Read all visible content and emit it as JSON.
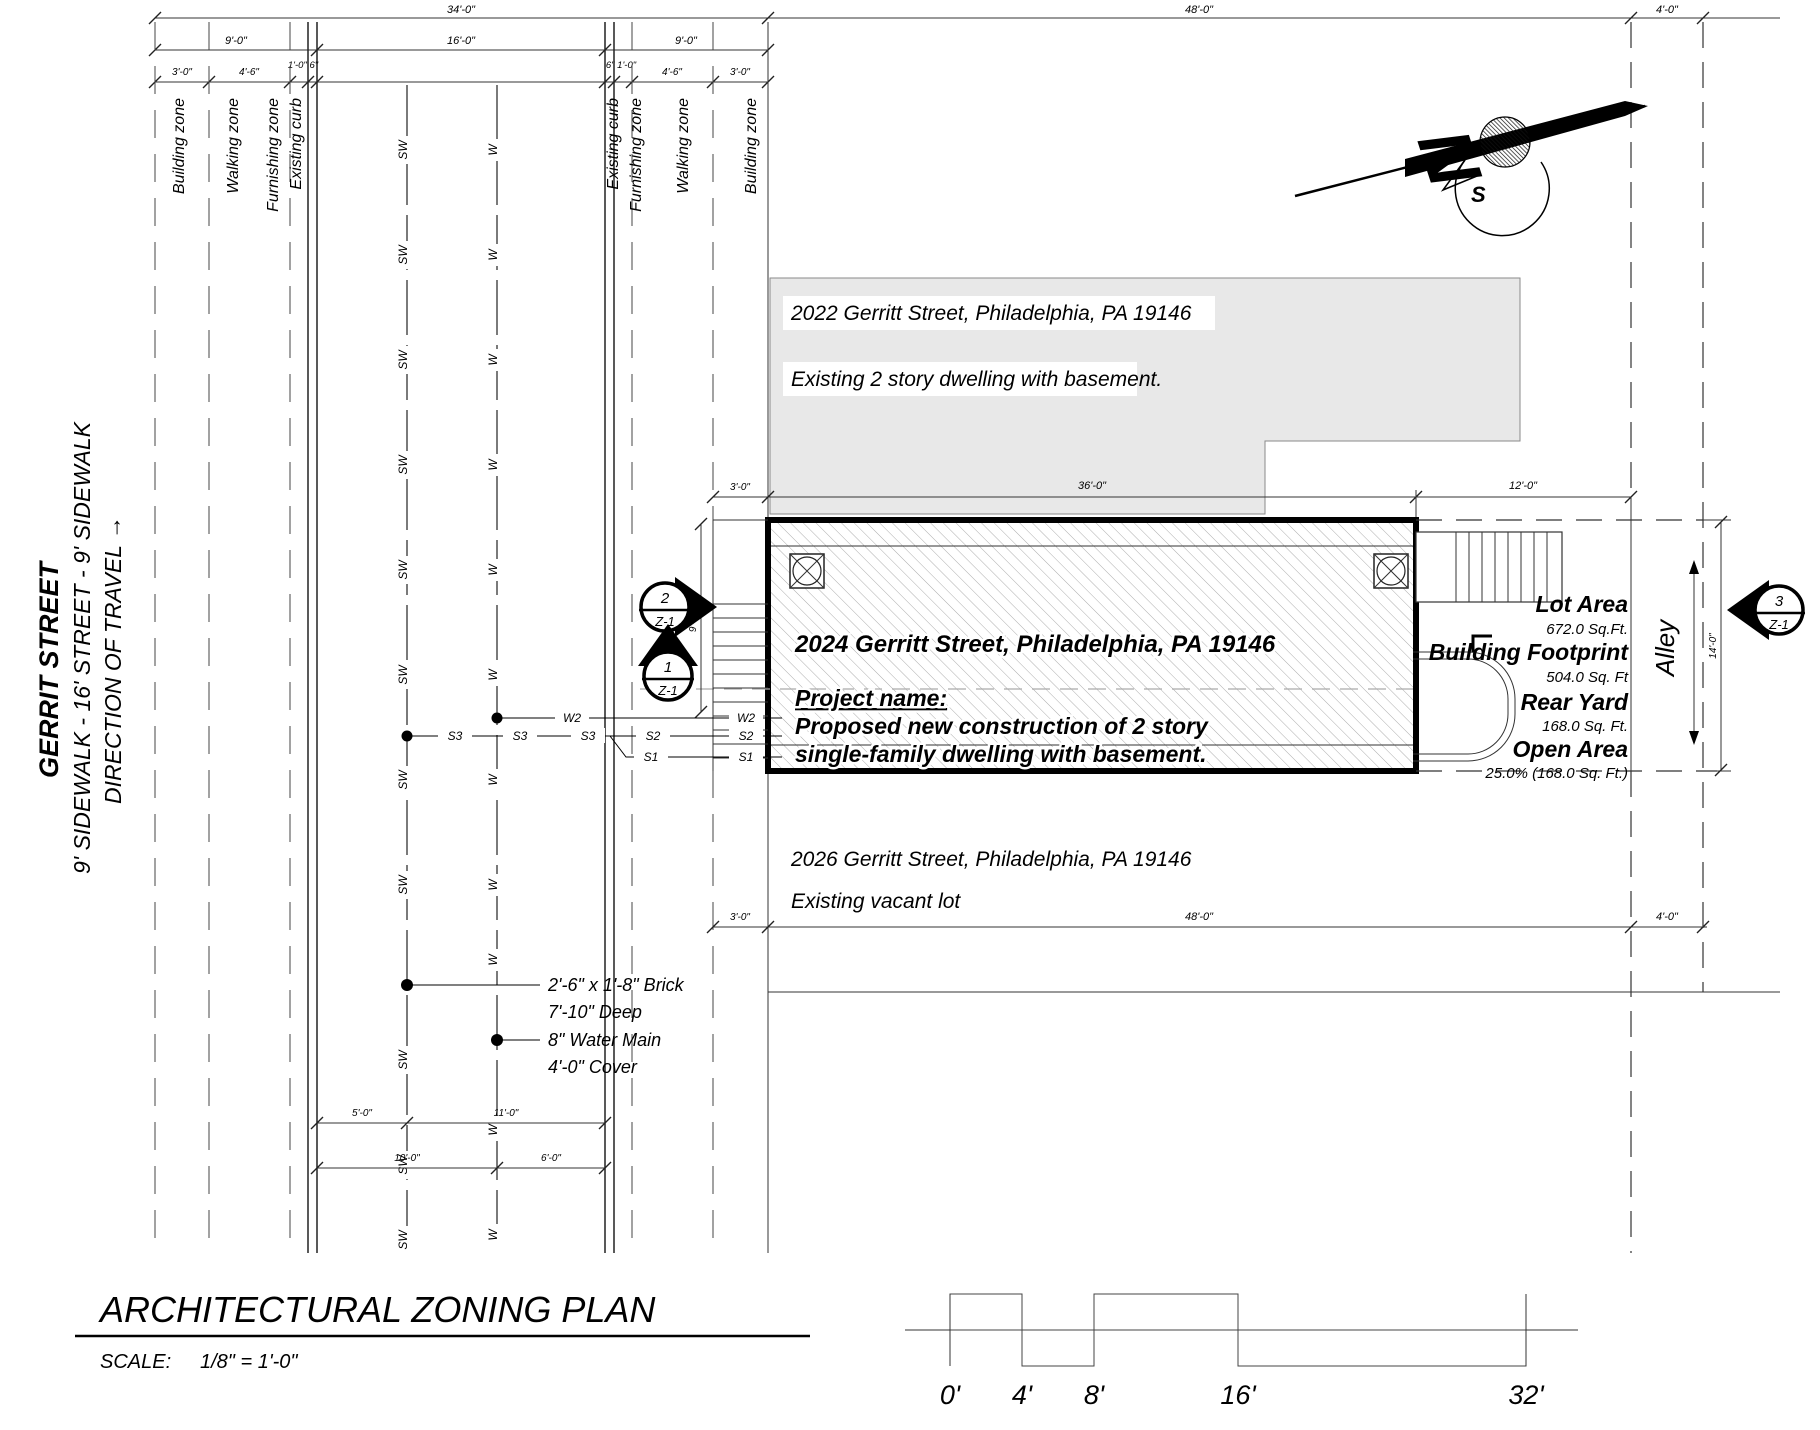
{
  "street": {
    "name": "GERRIT STREET",
    "subtitle": "9' SIDEWALK - 16' STREET - 9' SIDEWALK",
    "direction": "DIRECTION OF TRAVEL →"
  },
  "zones": {
    "building": "Building zone",
    "walking": "Walking zone",
    "furnishing": "Furnishing zone",
    "curb": "Existing curb"
  },
  "dims": {
    "top": {
      "overall_left": "34'-0\"",
      "overall_right": "48'-0\"",
      "alley": "4'-0\""
    },
    "row2": {
      "left_sidewalk": "9'-0\"",
      "street": "16'-0\"",
      "right_sidewalk": "9'-0\""
    },
    "row3": {
      "l_building": "3'-0\"",
      "l_walking": "4'-6\"",
      "l_curb": "1'-0\" 6\"",
      "r_curb": "6\" 1'-0\"",
      "r_walking": "4'-6\"",
      "r_building": "3'-0\""
    },
    "mid": {
      "setback": "3'-0\"",
      "building": "36'-0\"",
      "rear": "12'-0\""
    },
    "lot": {
      "setback": "3'-0\"",
      "width": "48'-0\"",
      "alley": "4'-0\""
    },
    "alley_depth": "14'-0\"",
    "stair": "9'-2¼\"",
    "street_utils": {
      "sw_offset": "5'-0\"",
      "sw_to_curb": "11'-0\"",
      "w_offset": "10'-0\"",
      "w_to_curb": "6'-0\""
    }
  },
  "utilities": {
    "sewer": "SW",
    "water": "W",
    "w2": "W2",
    "s1": "S1",
    "s2": "S2",
    "s3": "S3",
    "brick_note_1": "2'-6\" x 1'-8\" Brick",
    "brick_note_2": "7'-10\" Deep",
    "water_note_1": "8\" Water Main",
    "water_note_2": "4'-0\" Cover"
  },
  "buildings": {
    "b2022": {
      "address": "2022 Gerritt Street, Philadelphia, PA 19146",
      "desc": "Existing 2 story dwelling with basement."
    },
    "b2024": {
      "address": "2024 Gerritt Street, Philadelphia, PA 19146",
      "project_label": "Project name:",
      "project_line1": "Proposed new construction of 2 story",
      "project_line2": "single-family dwelling with basement."
    },
    "b2026": {
      "address": "2026 Gerritt Street, Philadelphia, PA 19146",
      "desc": "Existing vacant lot"
    }
  },
  "stats": [
    {
      "label": "Lot Area",
      "value": "672.0 Sq.Ft."
    },
    {
      "label": "Building Footprint",
      "value": "504.0 Sq. Ft"
    },
    {
      "label": "Rear Yard",
      "value": "168.0 Sq. Ft."
    },
    {
      "label": "Open Area",
      "value": "25.0% (168.0 Sq. Ft.)"
    }
  ],
  "alley": {
    "label": "Alley"
  },
  "callouts": {
    "c1": {
      "num": "1",
      "sheet": "Z-1"
    },
    "c2": {
      "num": "2",
      "sheet": "Z-1"
    },
    "c3": {
      "num": "3",
      "sheet": "Z-1"
    }
  },
  "north_arrow": {
    "n": "N",
    "s": "S"
  },
  "title_block": {
    "title": "ARCHITECTURAL ZONING PLAN",
    "scale_label": "SCALE:",
    "scale_value": "1/8\" = 1'-0\""
  },
  "scale_bar": {
    "labels": [
      "0'",
      "4'",
      "8'",
      "16'",
      "32'"
    ]
  },
  "colors": {
    "existing_fill": "#e8e8e8",
    "hatch": "#adadad"
  }
}
